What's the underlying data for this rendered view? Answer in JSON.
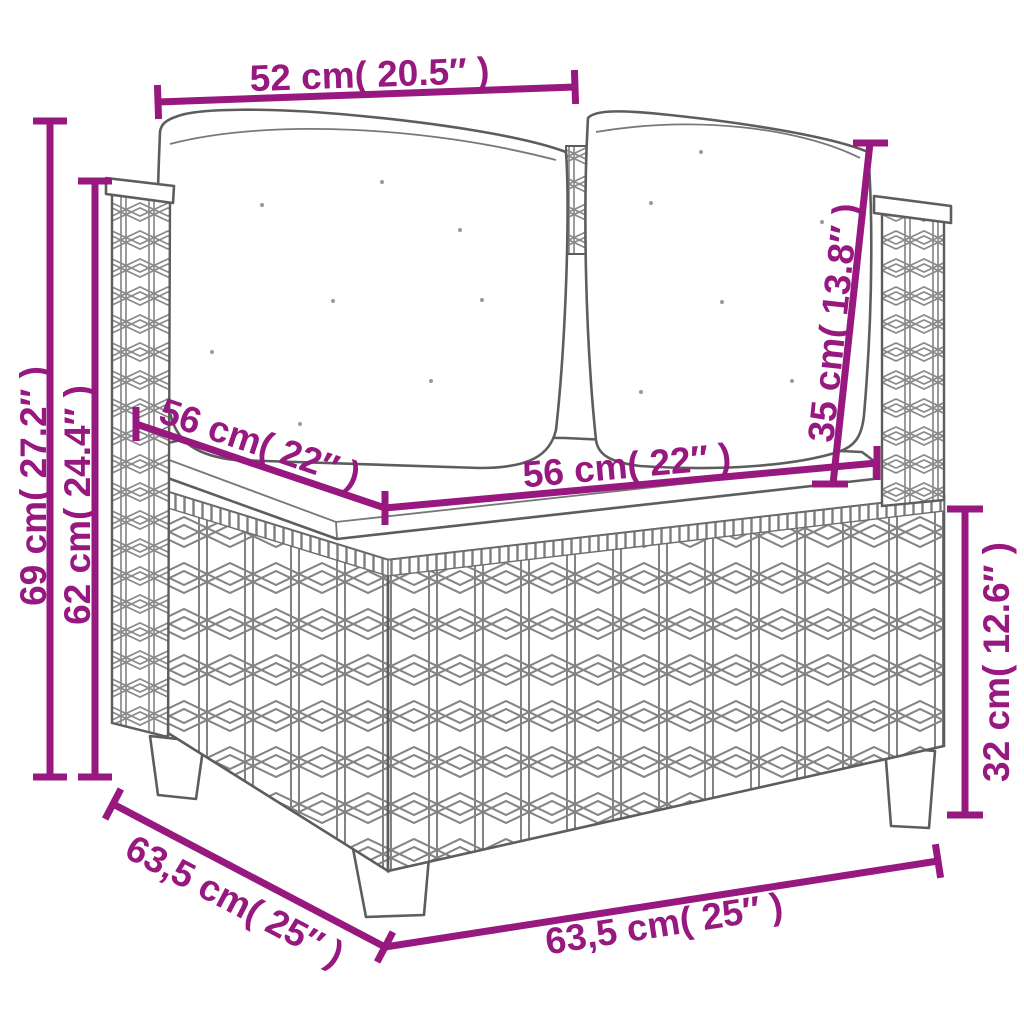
{
  "figure": {
    "title": "corner-sofa-dimension-diagram",
    "illustration": "poly rattan corner sofa section with two back cushions and seat cushion",
    "accent_color": "#97187F",
    "sketch_color": "#5d5d5d",
    "background": "#ffffff",
    "dimensions": {
      "top_width": "52 cm( 20.5″ )",
      "height_total": "69 cm( 27.2″ )",
      "height_arm": "62 cm( 24.4″ )",
      "seat_depth": "56 cm( 22″ )",
      "seat_width": "56 cm( 22″ )",
      "backrest_height": "35 cm( 13.8″ )",
      "base_height": "32 cm( 12.6″ )",
      "base_depth": "63,5 cm( 25″ )",
      "base_width": "63,5 cm( 25″ )"
    }
  }
}
